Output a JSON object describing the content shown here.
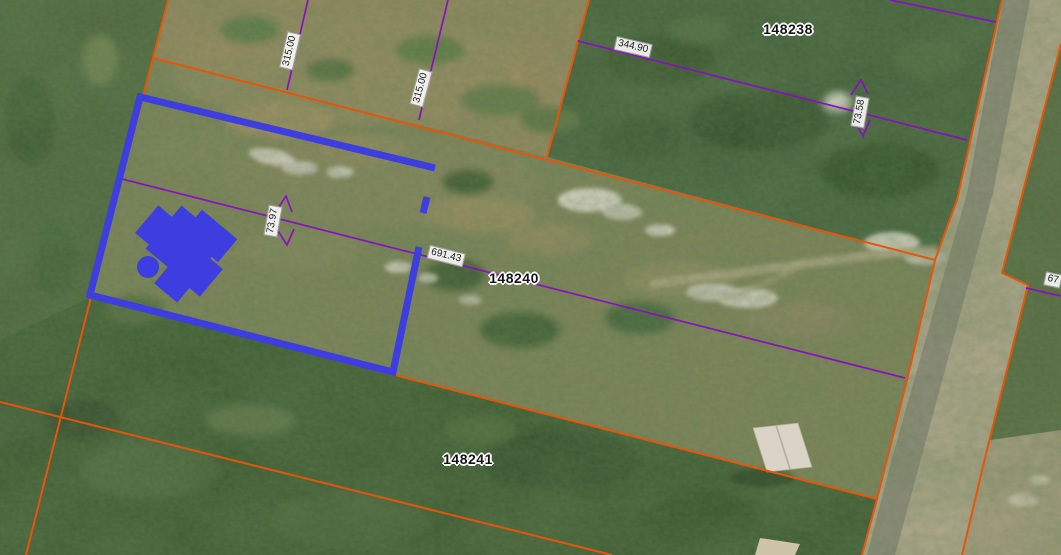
{
  "map": {
    "description": "Aerial parcel map with selected parcel highlighted",
    "parcel_labels": [
      {
        "id": "148238"
      },
      {
        "id": "148240"
      },
      {
        "id": "148241"
      }
    ],
    "dimension_labels": [
      {
        "value": "315.00"
      },
      {
        "value": "315.00"
      },
      {
        "value": "344.90"
      },
      {
        "value": "73.97"
      },
      {
        "value": "691.43"
      },
      {
        "value": "73.58"
      },
      {
        "value": "67"
      }
    ],
    "legend_colors": {
      "parcel_boundary": "#e8540a",
      "lot_line": "#8a10c0",
      "selected_parcel": "#3d3de0"
    }
  }
}
